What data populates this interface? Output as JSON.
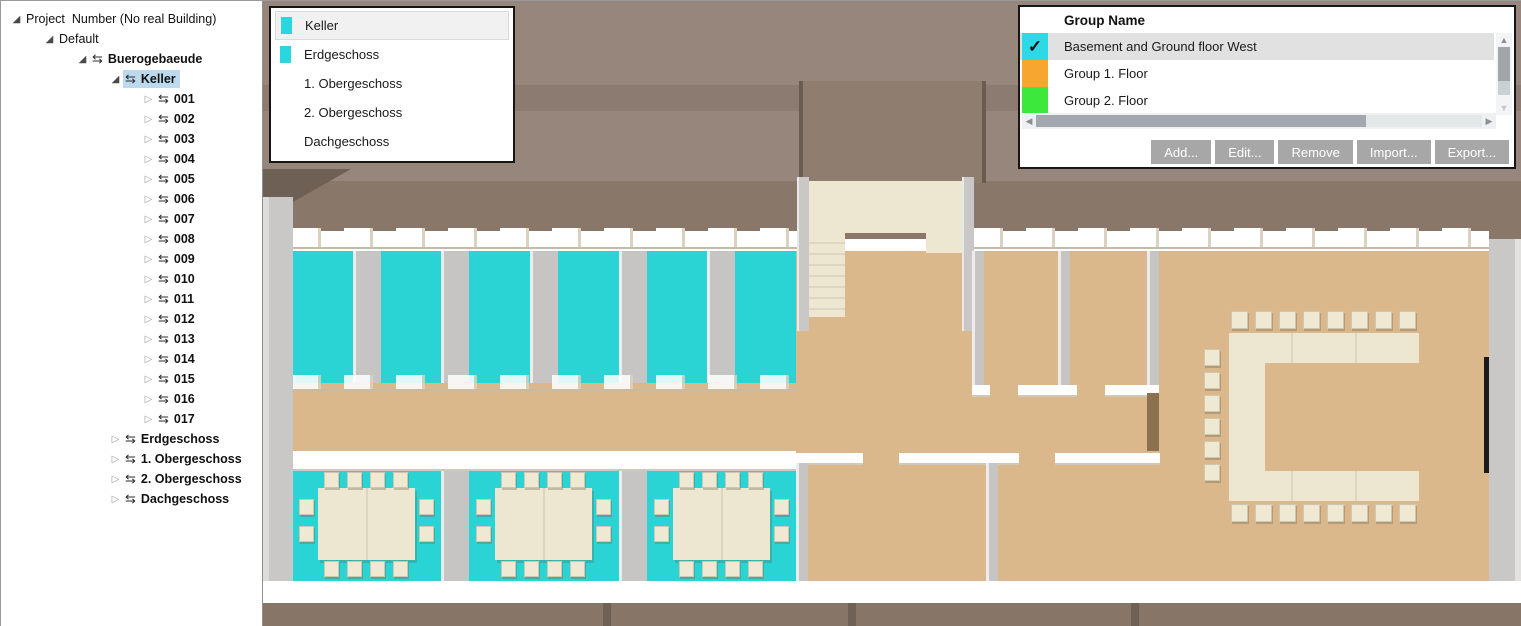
{
  "colors": {
    "group_cyan": "#2ed9e6",
    "group_orange": "#f7a62f",
    "group_green": "#3be83b",
    "floor_highlight_cyan": "#2bd4d4",
    "tree_selection": "#bcd9ee",
    "floor_tan": "#dbb88c",
    "table_cream": "#ede6d1"
  },
  "tree": {
    "items": [
      {
        "label": "Project  Number (No real Building)",
        "level": 0,
        "state": "open",
        "arrow": false,
        "bold": false
      },
      {
        "label": "Default",
        "level": 1,
        "state": "open",
        "arrow": false,
        "bold": false
      },
      {
        "label": "Buerogebaeude",
        "level": 2,
        "state": "open",
        "arrow": true,
        "bold": true
      },
      {
        "label": "Keller",
        "level": 3,
        "state": "open",
        "arrow": true,
        "bold": true,
        "selected": true
      },
      {
        "label": "001",
        "level": 4,
        "state": "closed",
        "arrow": true,
        "bold": true
      },
      {
        "label": "002",
        "level": 4,
        "state": "closed",
        "arrow": true,
        "bold": true
      },
      {
        "label": "003",
        "level": 4,
        "state": "closed",
        "arrow": true,
        "bold": true
      },
      {
        "label": "004",
        "level": 4,
        "state": "closed",
        "arrow": true,
        "bold": true
      },
      {
        "label": "005",
        "level": 4,
        "state": "closed",
        "arrow": true,
        "bold": true
      },
      {
        "label": "006",
        "level": 4,
        "state": "closed",
        "arrow": true,
        "bold": true
      },
      {
        "label": "007",
        "level": 4,
        "state": "closed",
        "arrow": true,
        "bold": true
      },
      {
        "label": "008",
        "level": 4,
        "state": "closed",
        "arrow": true,
        "bold": true
      },
      {
        "label": "009",
        "level": 4,
        "state": "closed",
        "arrow": true,
        "bold": true
      },
      {
        "label": "010",
        "level": 4,
        "state": "closed",
        "arrow": true,
        "bold": true
      },
      {
        "label": "011",
        "level": 4,
        "state": "closed",
        "arrow": true,
        "bold": true
      },
      {
        "label": "012",
        "level": 4,
        "state": "closed",
        "arrow": true,
        "bold": true
      },
      {
        "label": "013",
        "level": 4,
        "state": "closed",
        "arrow": true,
        "bold": true
      },
      {
        "label": "014",
        "level": 4,
        "state": "closed",
        "arrow": true,
        "bold": true
      },
      {
        "label": "015",
        "level": 4,
        "state": "closed",
        "arrow": true,
        "bold": true
      },
      {
        "label": "016",
        "level": 4,
        "state": "closed",
        "arrow": true,
        "bold": true
      },
      {
        "label": "017",
        "level": 4,
        "state": "closed",
        "arrow": true,
        "bold": true
      },
      {
        "label": "Erdgeschoss",
        "level": 3,
        "state": "closed",
        "arrow": true,
        "bold": true
      },
      {
        "label": "1. Obergeschoss",
        "level": 3,
        "state": "closed",
        "arrow": true,
        "bold": true
      },
      {
        "label": "2. Obergeschoss",
        "level": 3,
        "state": "closed",
        "arrow": true,
        "bold": true
      },
      {
        "label": "Dachgeschoss",
        "level": 3,
        "state": "closed",
        "arrow": true,
        "bold": true
      }
    ]
  },
  "floors_panel": {
    "items": [
      {
        "label": "Keller",
        "swatch": "#2bd7de",
        "selected": true
      },
      {
        "label": "Erdgeschoss",
        "swatch": "#2bd7de"
      },
      {
        "label": "1. Obergeschoss"
      },
      {
        "label": "2. Obergeschoss"
      },
      {
        "label": "Dachgeschoss"
      }
    ]
  },
  "groups_panel": {
    "header": "Group Name",
    "groups": [
      {
        "label": "Basement and Ground floor West",
        "color": "#2ed9e6",
        "checked": true,
        "selected": true
      },
      {
        "label": "Group 1. Floor",
        "color": "#f7a62f",
        "checked": false
      },
      {
        "label": "Group 2. Floor",
        "color": "#3be83b",
        "checked": false
      }
    ],
    "buttons": [
      "Add...",
      "Edit...",
      "Remove",
      "Import...",
      "Export..."
    ]
  }
}
